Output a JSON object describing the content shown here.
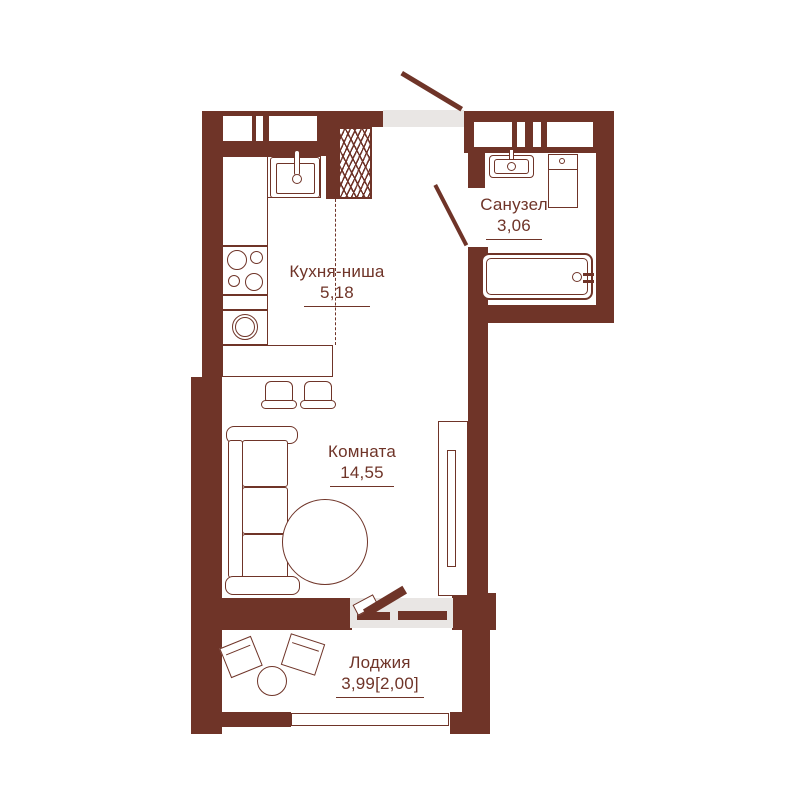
{
  "title": "Studio apartment floor plan",
  "colors": {
    "wall": "#6f3428",
    "threshold": "#e9e6e4",
    "background": "#ffffff"
  },
  "rooms": [
    {
      "key": "kitchen",
      "label": "Кухня-ниша",
      "area": "5,18"
    },
    {
      "key": "living",
      "label": "Комната",
      "area": "14,55"
    },
    {
      "key": "bathroom",
      "label": "Санузел",
      "area": "3,06"
    },
    {
      "key": "loggia",
      "label": "Лоджия",
      "area": "3,99[2,00]"
    }
  ],
  "icons": [
    "entry-door-icon",
    "bathroom-door-icon",
    "balcony-door-icon",
    "ventilation-shaft-icon",
    "kitchen-sink-icon",
    "cooktop-icon",
    "washing-machine-icon",
    "bar-counter",
    "bar-stool-icon",
    "sofa-icon",
    "round-table-icon",
    "wardrobe-icon",
    "bathroom-sink-icon",
    "bathroom-appliance-icon",
    "bathtub-icon",
    "loggia-chair-icon",
    "loggia-table-icon",
    "loggia-window"
  ]
}
